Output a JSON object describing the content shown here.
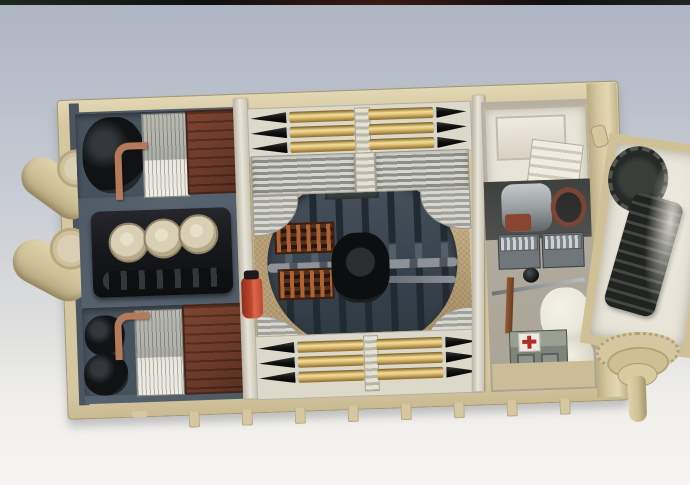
{
  "scene": {
    "type": "photograph",
    "subject": "scale-model-tank-hull-interior",
    "view": "overhead",
    "regions": {
      "engine_bay": "engine block with three circular air cleaners flanked by two radiator/fan bays with copper piping and brown radiator boxes",
      "fighting_compartment": "turret-ring opening in tread-plate floor showing torsion bars, drive shaft, ring gearbox and two ammunition bins; brass shell racks fore and aft",
      "crew_compartment": "ivory fuel tank, transmission, steering wheel, two radio sets, first-aid box with red cross, white crew seat",
      "right_assembly": "open box with drive sprocket gear and spare track links, final-drive housing with axle peg",
      "left_edge": "two tan exhaust mufflers",
      "hull_bottom": "tan hull edge with small suspension tabs"
    }
  },
  "counts": {
    "ammo_shells_top_rack": 6,
    "ammo_shells_bottom_rack": 6,
    "air_cleaners": 3,
    "torsion_bars": 7,
    "radio_sets": 2,
    "exhaust_mufflers": 2,
    "hull_bottom_tabs": 8
  },
  "palette": {
    "backdrop-top": "#adb5c3",
    "backdrop-mid": "#c9cdd4",
    "backdrop-bottom": "#f6f5f2",
    "film-edge": "#101010",
    "hull-tan": "#d5c7a0",
    "hull-tan-dark": "#b3a279",
    "hull-tan-light": "#e3d8b4",
    "interior-gray": "#57636f",
    "interior-gray-dark": "#46525c",
    "engine-black": "#17181b",
    "cream": "#d8cfb4",
    "silver": "#aeafa8",
    "silver-light": "#d6d5cf",
    "white-ivory": "#e8e4d8",
    "radiator-brown": "#6b3929",
    "radiator-brown-dark": "#47231a",
    "copper": "#b57a5c",
    "brass": "#e6c87e",
    "brass-dark": "#8a6a2a",
    "projectile-black": "#121212",
    "floor-tan": "#c3ac84",
    "floor-tan-dark": "#a98f66",
    "lower-hull": "#39434d",
    "torsion-dark": "#222a31",
    "shaft-silver": "#8d9298",
    "bin-brown": "#54301f",
    "bin-orange": "#b06330",
    "red": "#c0452e",
    "cross-red": "#b22a22",
    "radio-gray": "#70767a",
    "seat-white": "#eae7dc",
    "track-black": "#20231f"
  }
}
